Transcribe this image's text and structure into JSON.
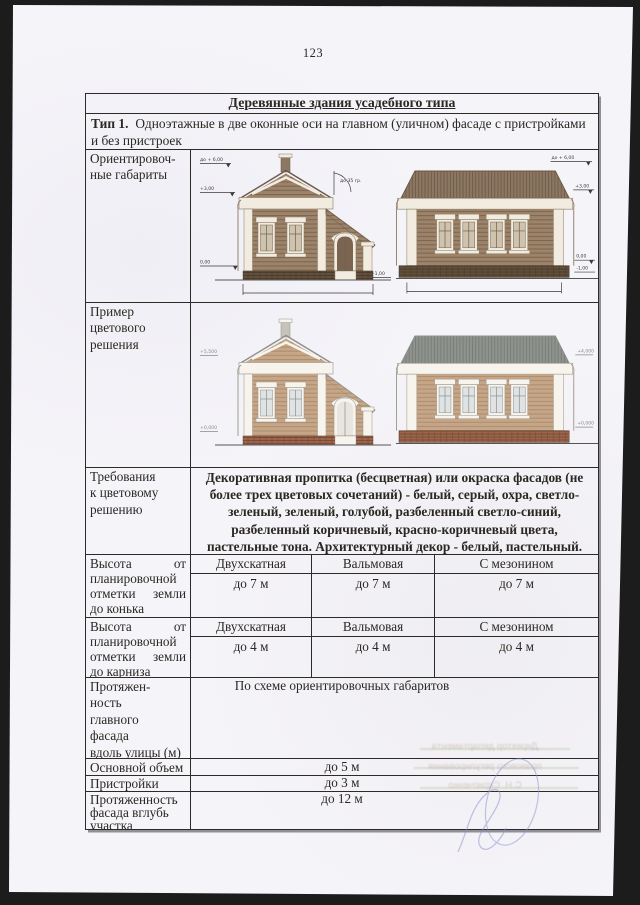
{
  "page": {
    "number": "123"
  },
  "table": {
    "title": "Деревянные здания усадебного типа",
    "type": {
      "label": "Тип 1.",
      "text": "Одноэтажные в две оконные оси на главном (уличном) фасаде с пристройками и без пристроек"
    },
    "rows": {
      "orient": {
        "label": "Ориентировоч-\nные габариты"
      },
      "colorex": {
        "label": "Пример\nцветового\nрешения"
      },
      "colorreq": {
        "label": "Требования\nк цветовому\nрешению",
        "text": "Декоративная пропитка (бесцветная) или окраска фасадов (не более трех цветовых сочетаний) - белый, серый, охра, светло-зеленый, зеленый, голубой, разбеленный светло-синий, разбеленный коричневый, красно-коричневый цвета, пастельные тона. Архитектурный декор - белый, пастельный."
      },
      "ridge": {
        "label": "Высота от планировочной отметки земли до конька",
        "cols": [
          {
            "type": "Двухскатная",
            "value": "до 7 м"
          },
          {
            "type": "Вальмовая",
            "value": "до 7 м"
          },
          {
            "type": "С мезонином",
            "value": "до 7 м"
          }
        ]
      },
      "eaves": {
        "label": "Высота от планировочной отметки земли до карниза",
        "cols": [
          {
            "type": "Двухскатная",
            "value": "до 4 м"
          },
          {
            "type": "Вальмовая",
            "value": "до 4 м"
          },
          {
            "type": "С мезонином",
            "value": "до 4 м"
          }
        ]
      },
      "facade_len": {
        "label": "Протяжен-\nность\nглавного\nфасада\nвдоль улицы (м)",
        "value": "По схеме ориентировочных габаритов"
      },
      "main_vol": {
        "label": "Основной объем",
        "value": "до 5 м"
      },
      "annex": {
        "label": "Пристройки",
        "value": "до 3 м"
      },
      "depth": {
        "label": "Протяженность\nфасада вглубь\nучастка",
        "value": "до 12 м"
      }
    }
  },
  "drawings": {
    "marks": {
      "max": "до + 6,00",
      "eave": "+3,00",
      "zero": "0,00",
      "minus": "-1,00",
      "angle": "до 35 гр."
    },
    "cmarks": {
      "a_top": "+5,500",
      "a_zero": "+0,000",
      "b_top": "+4,000",
      "b_zero": "+0,000"
    },
    "palette": {
      "mono_wall": "#9c8369",
      "color_wall": "#c6a687",
      "color_roof": "#8f938e",
      "color_foundation": "#9c654e",
      "trim": "#f1ecdf"
    }
  },
  "artifacts": {
    "bleed": [
      "Директор департамента",
      "правового регулирования",
      "С.Н. Скрипченко"
    ]
  }
}
